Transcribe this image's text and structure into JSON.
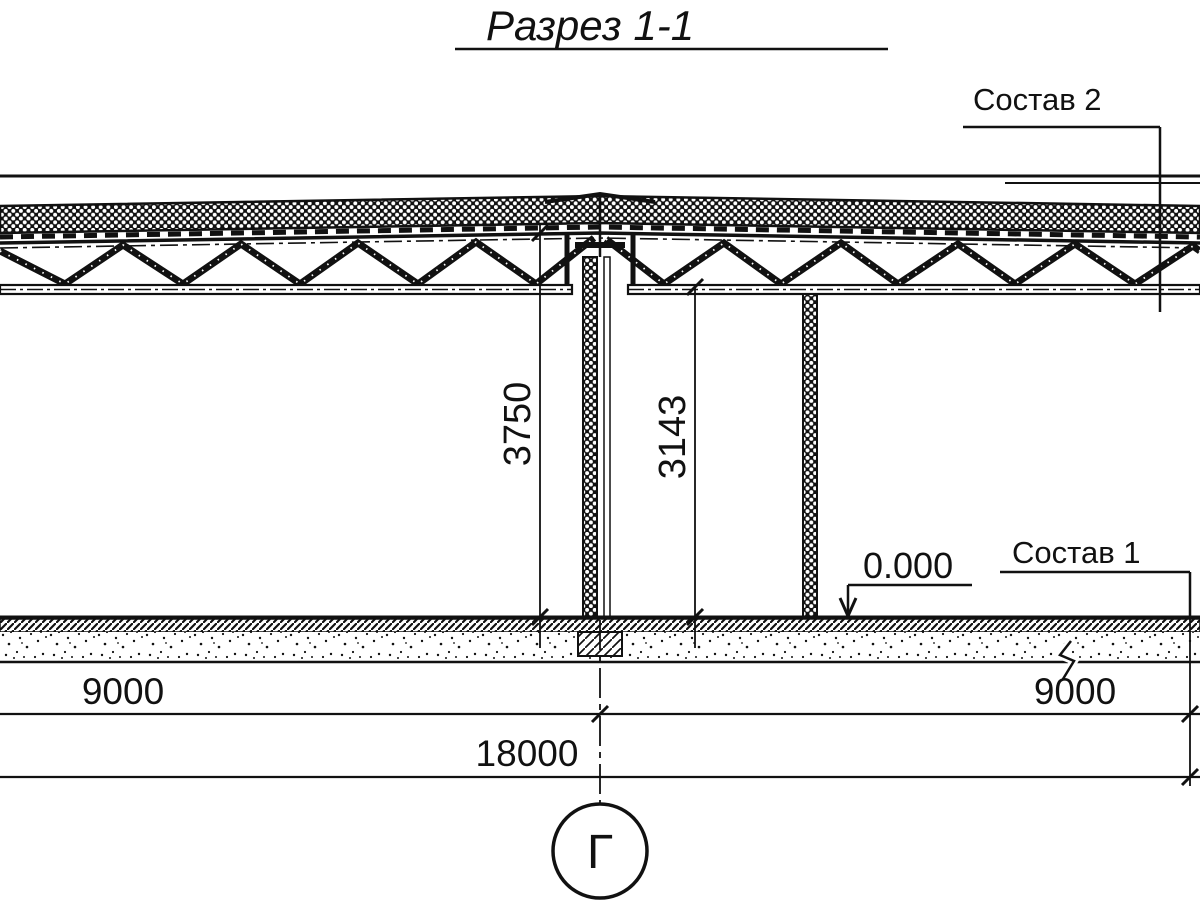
{
  "title": "Разрез 1-1",
  "labels": {
    "composition2": "Состав 2",
    "composition1": "Состав 1",
    "elevation_zero": "0.000",
    "axis_letter": "Г"
  },
  "dimensions": {
    "height_floor_to_roof": "3750",
    "height_floor_to_truss": "3143",
    "span_left": "9000",
    "span_right": "9000",
    "span_total": "18000"
  },
  "colors": {
    "ink": "#111111",
    "background": "#ffffff"
  }
}
